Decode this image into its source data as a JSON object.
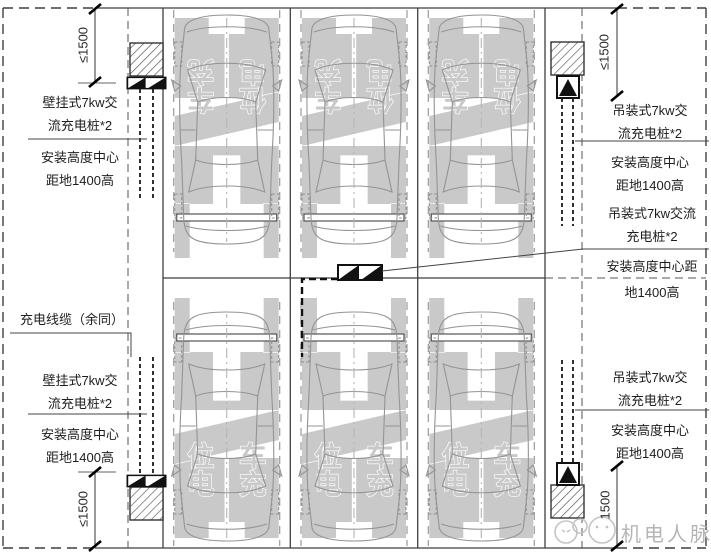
{
  "annotations": {
    "left": {
      "top_charger": {
        "l1": "壁挂式7kw交",
        "l2": "流充电桩*2"
      },
      "top_note": {
        "l1": "安装高度中心",
        "l2": "距地1400高"
      },
      "cable": "充电线缆（余同）",
      "bottom_charger": {
        "l1": "壁挂式7kw交",
        "l2": "流充电桩*2"
      },
      "bottom_note": {
        "l1": "安装高度中心",
        "l2": "距地1400高"
      }
    },
    "right": {
      "top_charger": {
        "l1": "吊装式7kw交",
        "l2": "流充电桩*2"
      },
      "top_note": {
        "l1": "安装高度中心",
        "l2": "距地1400高"
      },
      "mid_charger": {
        "l1": "吊装式7kw交流",
        "l2": "充电桩*2"
      },
      "mid_note": {
        "l1": "安装高度中心距",
        "l2": "地1400高"
      },
      "bottom_charger": {
        "l1": "吊装式7kw交",
        "l2": "流充电桩*2"
      },
      "bottom_note": {
        "l1": "安装高度中心",
        "l2": "距地1400高"
      }
    }
  },
  "dimensions": {
    "top_left": "≤1500",
    "bottom_left": "≤1500",
    "top_right": "≤1500",
    "bottom_right": "1500"
  },
  "spot_marking": {
    "c1": "充",
    "c2": "电",
    "c3": "车",
    "c4": "位"
  },
  "watermark": "机电人脉",
  "colors": {
    "line": "#3f3f3f",
    "marking": "#c9c9c9",
    "cable": "#1a1a1a",
    "watermark": "#b5b5b5"
  }
}
